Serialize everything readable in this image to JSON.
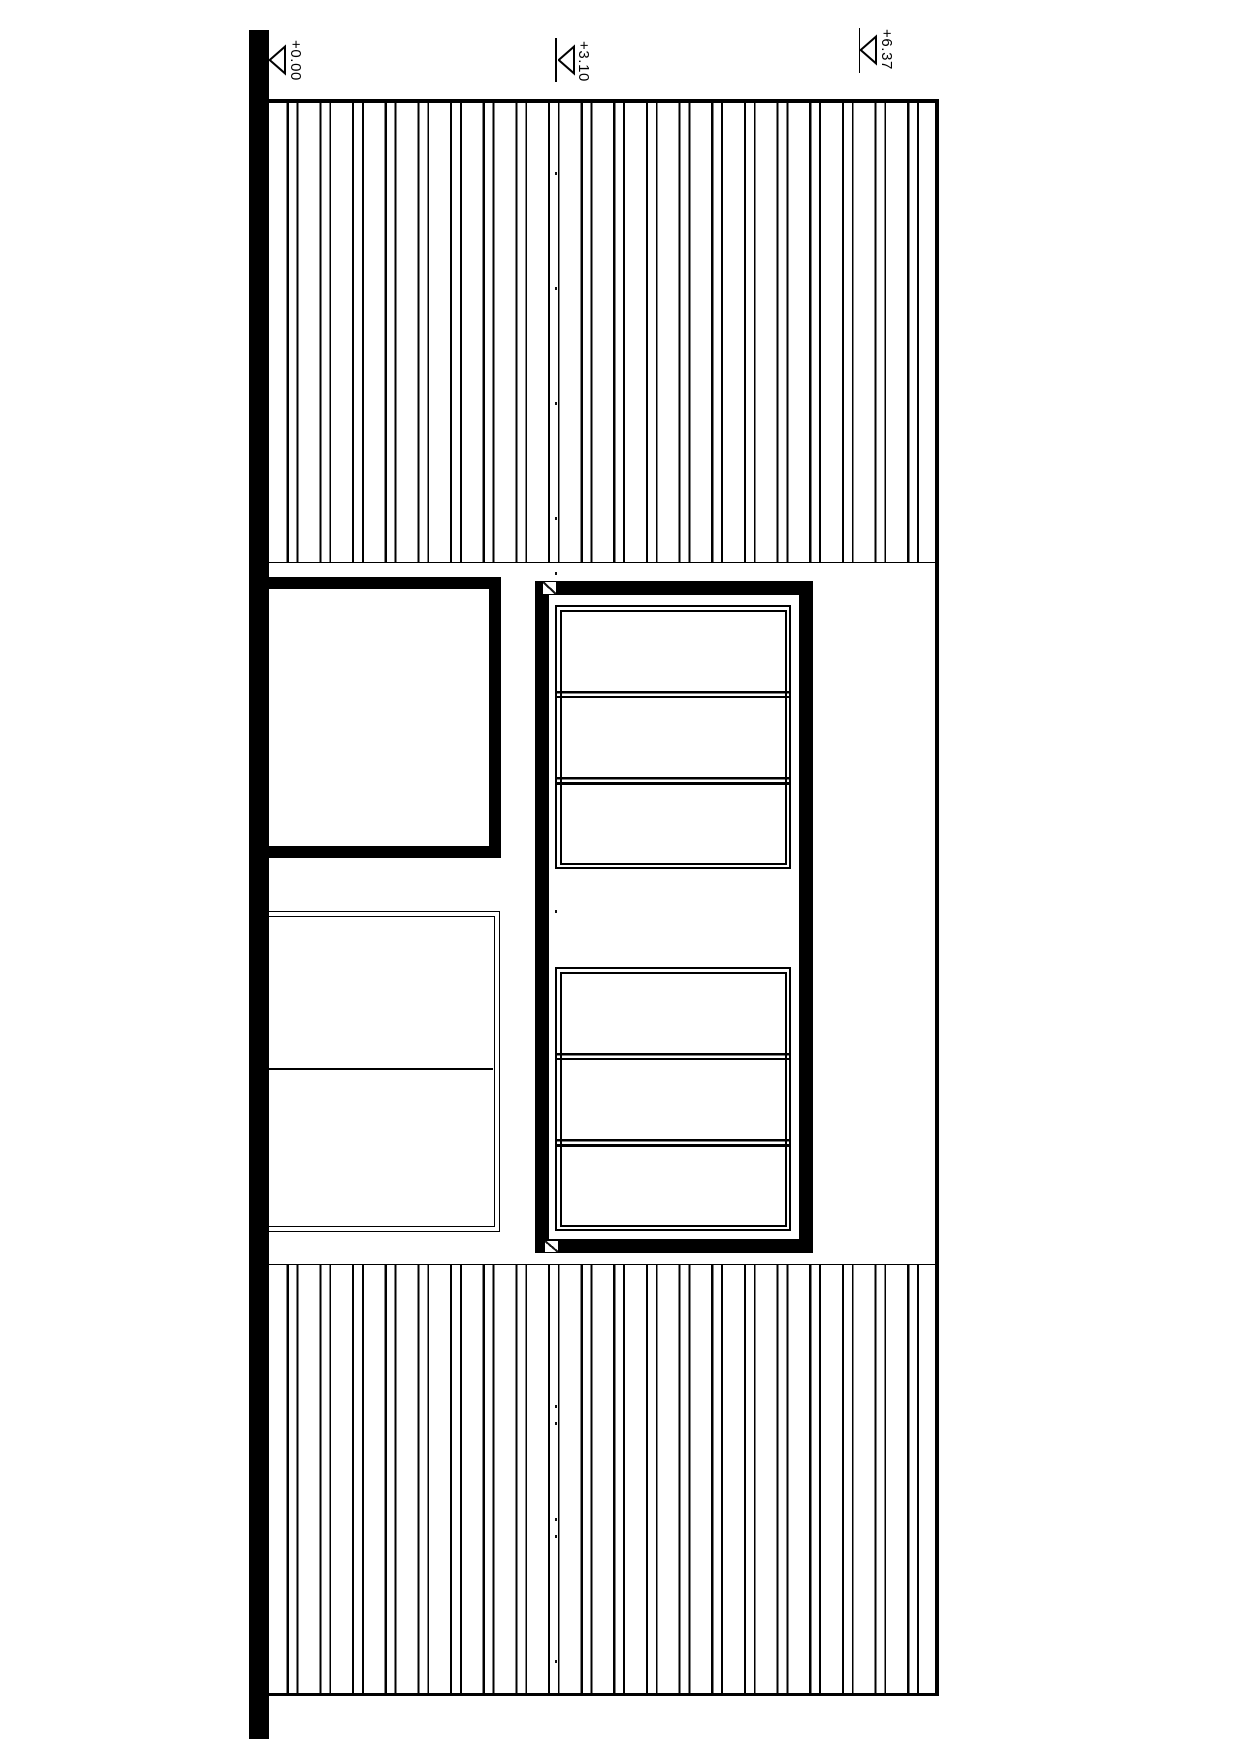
{
  "drawing": {
    "colors": {
      "ink": "#000000",
      "paper": "#ffffff"
    },
    "level_markers": [
      {
        "label": "+0.00"
      },
      {
        "label": "+3.10"
      },
      {
        "label": "+6.37"
      }
    ],
    "datum_marks_y": [
      172,
      287,
      402,
      517,
      572,
      910,
      1405,
      1422,
      1518,
      1535,
      1660
    ]
  }
}
